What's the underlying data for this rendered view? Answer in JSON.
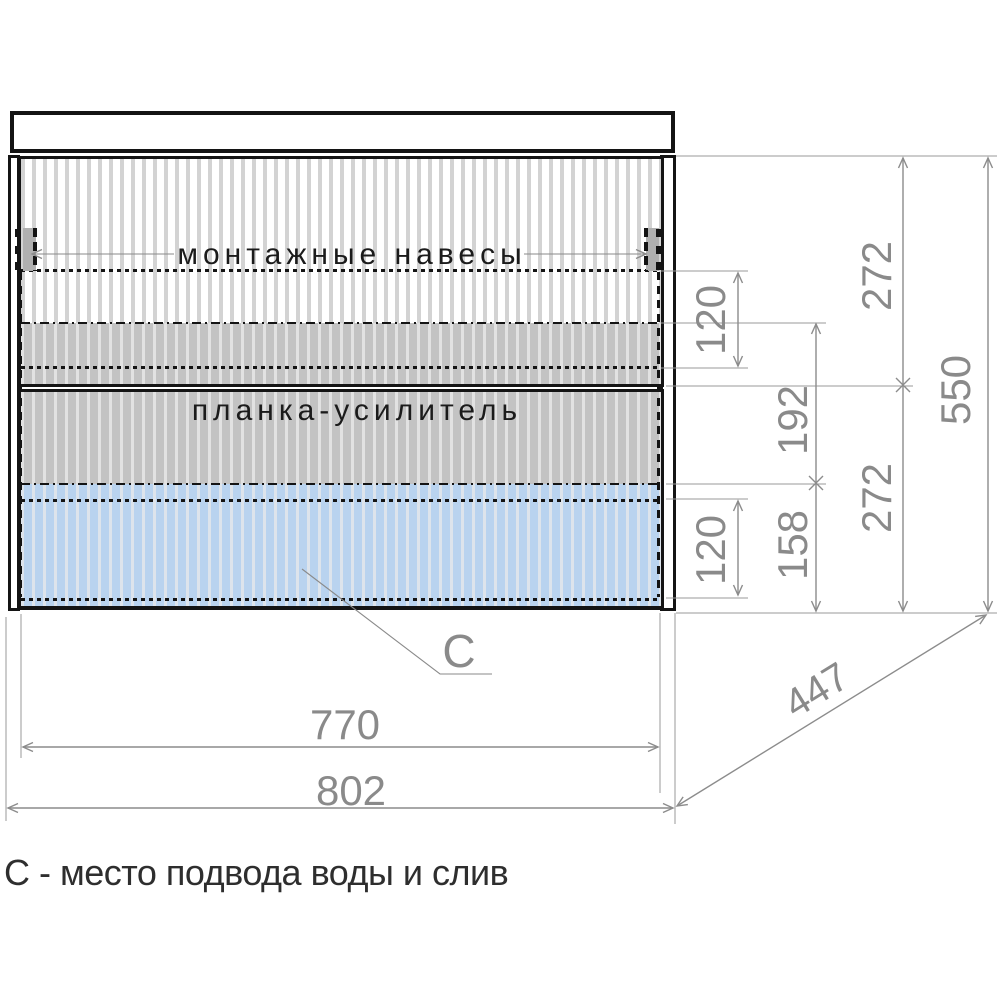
{
  "cabinet": {
    "labels": {
      "mounting_hangers": "монтажные навесы",
      "reinforcement_bar": "планка-усилитель",
      "connection_marker": "С"
    },
    "note": "С - место подвода воды и слив"
  },
  "dimensions": {
    "upper_section_height": "272",
    "lower_section_height": "272",
    "total_height": "550",
    "hanger_zone_offset": "120",
    "reinforcement_height": "192",
    "bottom_zone_height": "158",
    "drain_zone_height": "120",
    "inner_width": "770",
    "overall_width": "802",
    "depth": "447"
  },
  "colors": {
    "drain_zone_blue": "#b9d3ef",
    "reinforcement_gray": "#c3c3c3",
    "dimension_gray": "#8a8a8a",
    "line_black": "#141414"
  }
}
